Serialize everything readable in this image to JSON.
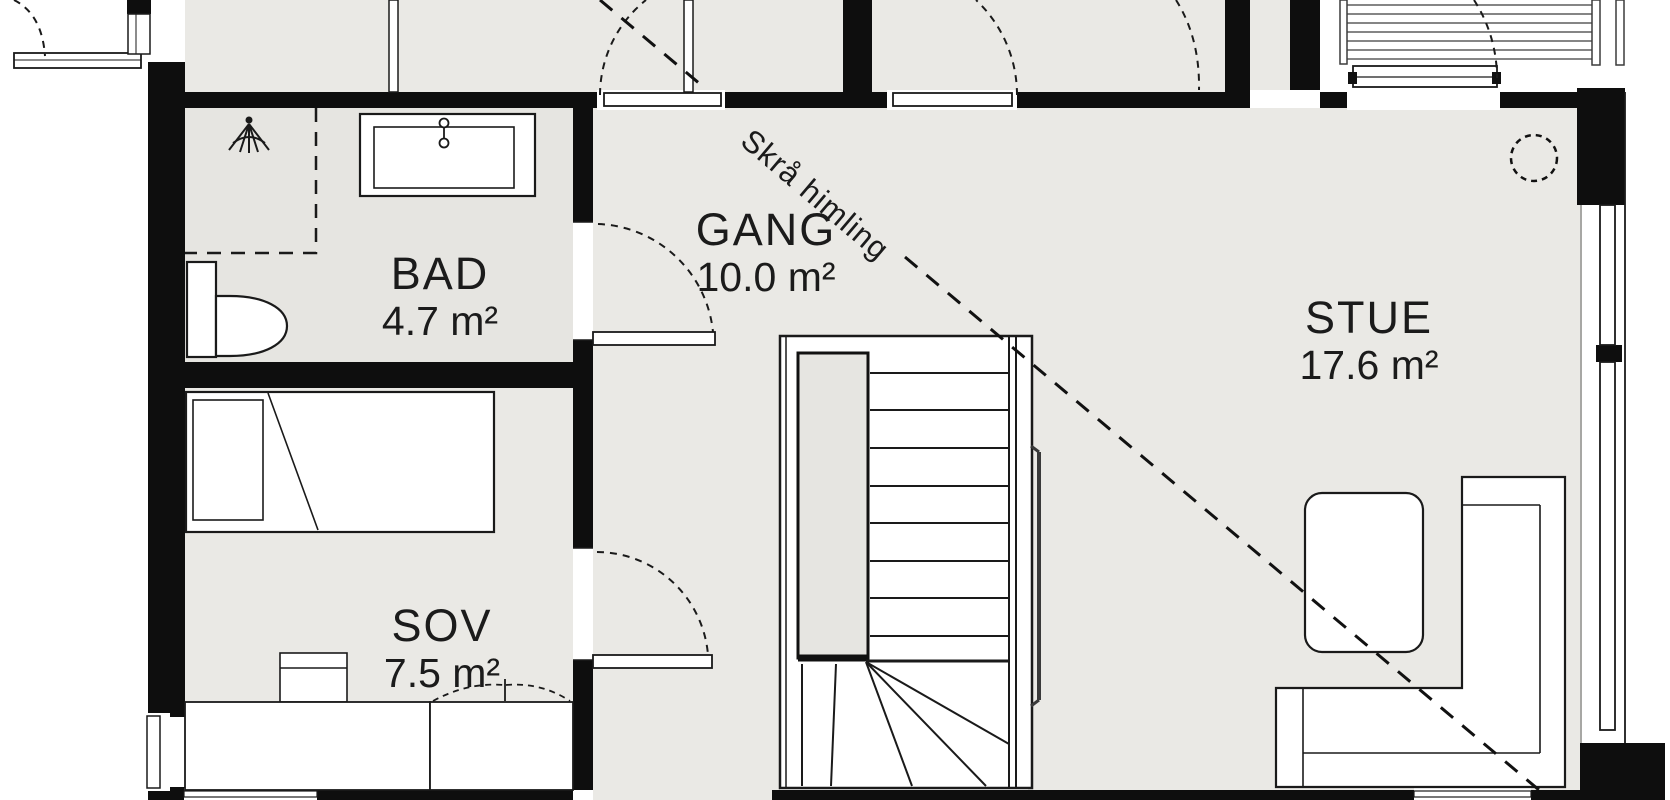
{
  "title": "Floor plan – upper level",
  "plan": {
    "rooms": [
      {
        "id": "bad",
        "name": "BAD",
        "area": "4.7 m²"
      },
      {
        "id": "gang",
        "name": "GANG",
        "area": "10.0 m²"
      },
      {
        "id": "sov",
        "name": "SOV",
        "area": "7.5 m²"
      },
      {
        "id": "stue",
        "name": "STUE",
        "area": "17.6 m²"
      }
    ],
    "annotation": {
      "sloped_ceiling": "Skrå himling"
    },
    "fixtures": [
      "shower-head-icon",
      "faucet-icon",
      "toilet",
      "vanity-sink"
    ],
    "furniture": [
      "bed",
      "desk-chair",
      "desk",
      "wardrobe",
      "armchair",
      "corner-sofa",
      "stairs"
    ],
    "colors": {
      "wall": "#0e0e0e",
      "floor": "#eae9e5",
      "floor_bad": "#e6e5e1",
      "line": "#1a1a1a",
      "background": "#ffffff"
    }
  }
}
